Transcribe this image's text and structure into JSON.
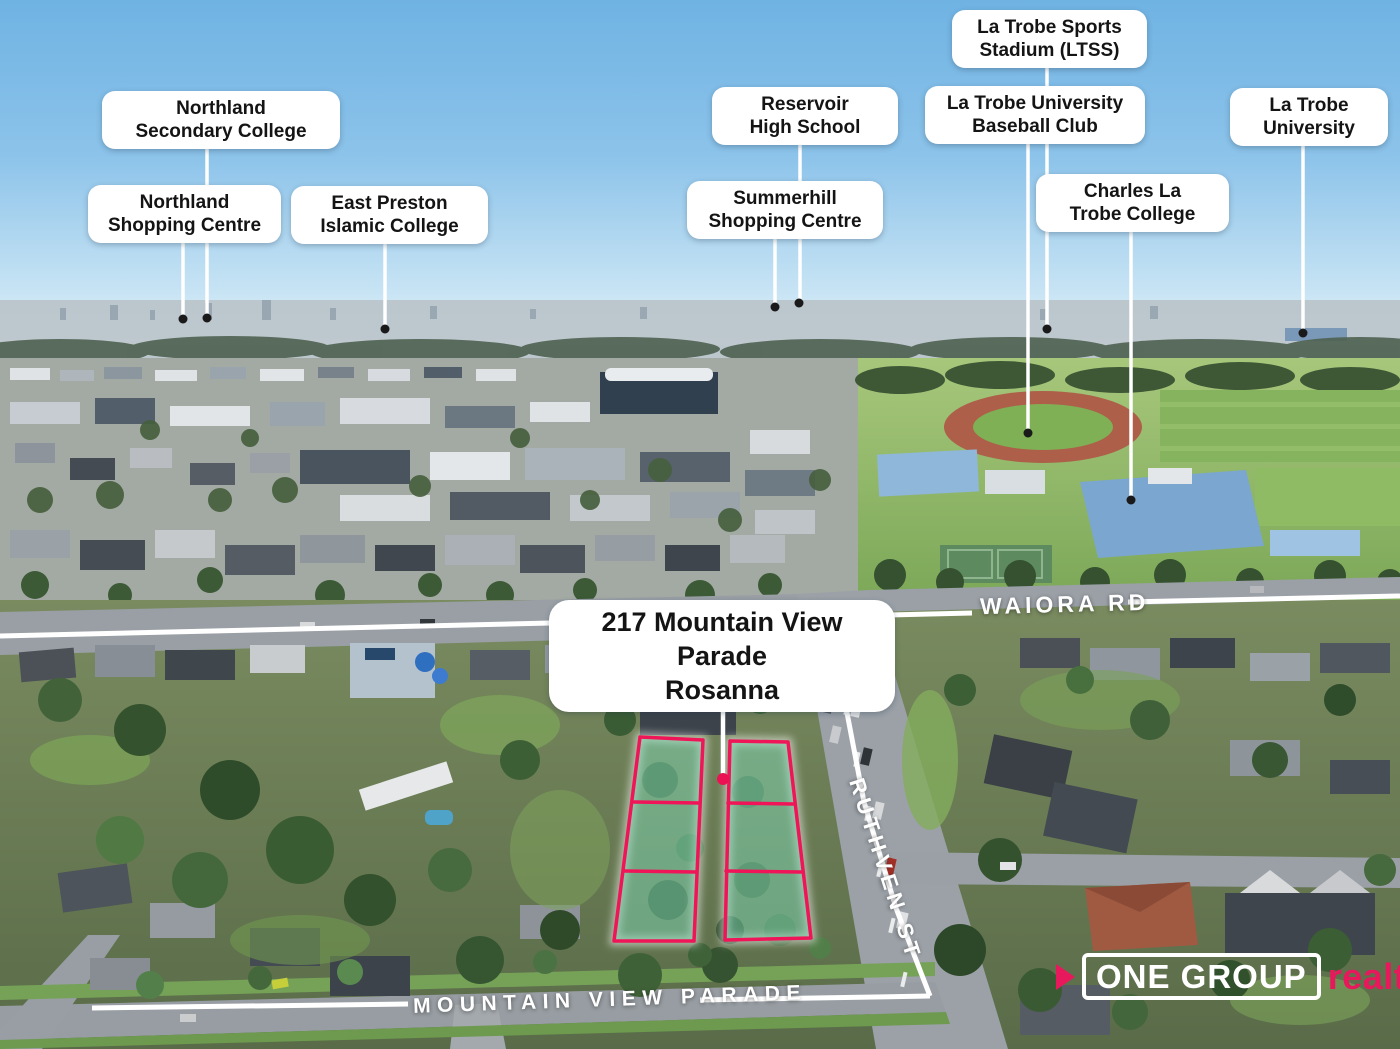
{
  "property_label": {
    "text": "217 Mountain View Parade\nRosanna"
  },
  "landmark_labels": [
    {
      "text": "Northland\nSecondary College"
    },
    {
      "text": "Northland\nShopping Centre"
    },
    {
      "text": "East Preston\nIslamic College"
    },
    {
      "text": "Reservoir\nHigh School"
    },
    {
      "text": "Summerhill\nShopping Centre"
    },
    {
      "text": "La Trobe Sports\nStadium (LTSS)"
    },
    {
      "text": "La Trobe University\nBaseball Club"
    },
    {
      "text": "Charles La\nTrobe College"
    },
    {
      "text": "La Trobe\nUniversity"
    }
  ],
  "street_labels": {
    "waiora": "WAIORA RD",
    "ruthven": "RUTHVEN ST",
    "mountain_view": "MOUNTAIN VIEW PARADE"
  },
  "logo": {
    "name": "ONE GROUP",
    "suffix": "realty"
  },
  "colors": {
    "brand_pink": "#e8185c",
    "lot_outline": "#f01458",
    "lot_fill": "rgba(126,214,180,0.5)",
    "sky_top": "#6fb3e3"
  }
}
